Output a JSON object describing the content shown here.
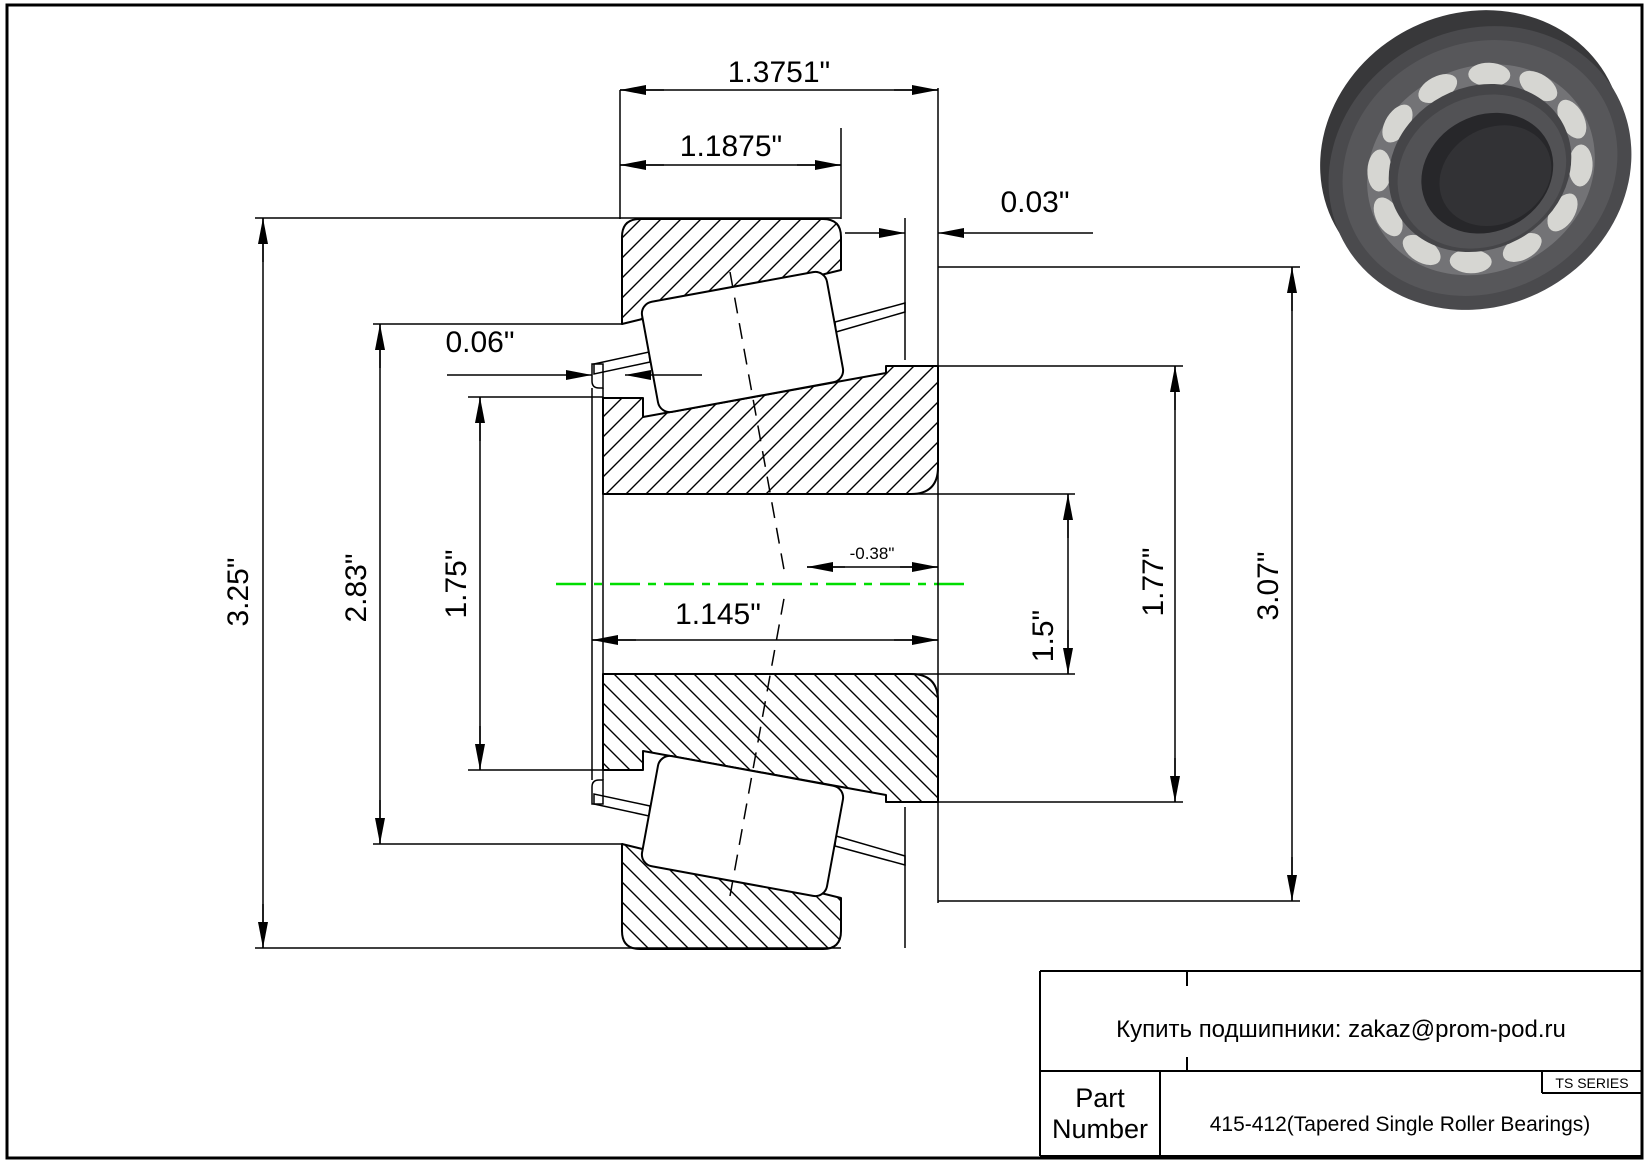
{
  "drawing_dims": {
    "overall_width": "1.3751\"",
    "cup_width": "1.1875\"",
    "cup_standout": "0.03\"",
    "cage_standout": "0.06\"",
    "outer_diameter": "3.25\"",
    "flange_diameter": "2.83\"",
    "race_diameter": "1.75\"",
    "cone_width": "1.145\"",
    "effective_center": "-0.38\"",
    "bore_diameter": "1.5\"",
    "rib_diameter": "1.77\"",
    "cup_diameter": "3.07\""
  },
  "title_block": {
    "contact_line": "Купить подшипники: zakaz@prom-pod.ru",
    "series_label": "TS SERIES",
    "part_label_line1": "Part",
    "part_label_line2": "Number",
    "part_value": "415-412(Tapered Single Roller Bearings)"
  },
  "colors": {
    "line": "#000000",
    "centerline": "#00dd00",
    "background": "#ffffff"
  }
}
